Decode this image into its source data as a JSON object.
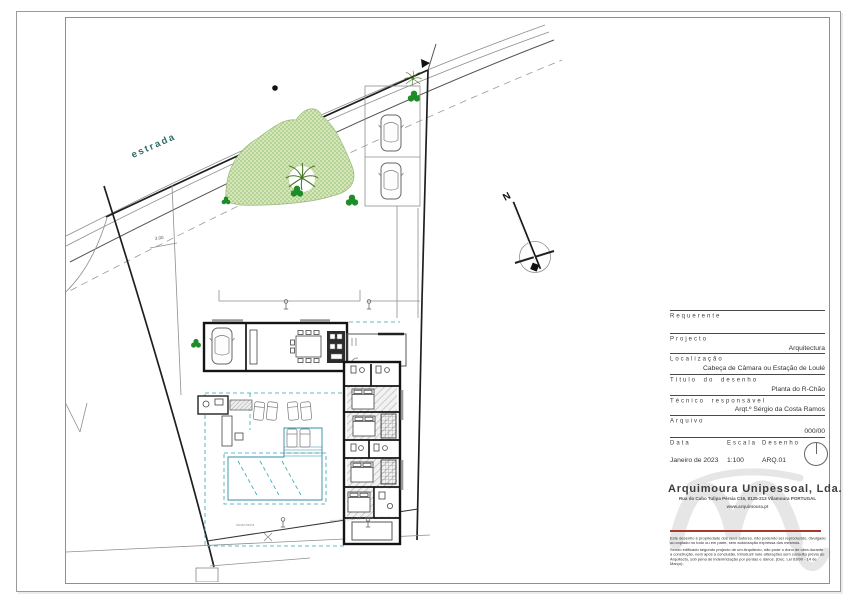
{
  "title_block": {
    "fields": [
      {
        "label": "Requerente",
        "value": ""
      },
      {
        "label": "Projecto",
        "value": "Arquitectura"
      },
      {
        "label": "Localização",
        "value": "Cabeça de Câmara ou Estação de Loulé"
      },
      {
        "label": "Título do desenho",
        "value": "Planta do R-Chão"
      },
      {
        "label": "Técnico responsável",
        "value": "Arqt.º Sérgio da Costa Ramos"
      },
      {
        "label": "Arquivo",
        "value": "000/00"
      }
    ],
    "meta": {
      "date_label": "Data",
      "date_value": "Janeiro de 2023",
      "scale_label": "Escala",
      "scale_value": "1:100",
      "drawing_label": "Desenho",
      "drawing_value": "ARQ.01"
    }
  },
  "company": {
    "name": "Arquimoura Unipessoal, Lda.",
    "address": "Rua do Cabo Tulipa Pérsia C16, 8125-213 Vilamoura PORTUGAL",
    "website": "www.arquimoura.pt",
    "disclaimer_1": "Este desenho é propriedade dos seus autores, não podendo ser reproduzido, divulgado ou copiado no todo ou em parte, sem autorização expressa dos mesmos.",
    "disclaimer_2": "Sendo edificado segundo projecto de um Arquitecto, não pode o dono de obra durante a construção, nem após a conclusão, introduzir nele alterações sem consulta prévia ao Arquitecto, sob pena de indemnização por perdas e danos. (Dec. Lei 63/90 - 14 de Março)."
  },
  "drawing": {
    "road_label": "estrada",
    "north_label": "N",
    "setback_dimension": "3.00",
    "annotation_left": "lavandaria",
    "annotation_right": "piso do r/chão 307.45m2"
  },
  "colors": {
    "pool": "#7ed1e4",
    "pool_deep": "#5fc6dc",
    "garden": "#d6e6b8",
    "garden_dot": "#8cbf6e",
    "tree": "#1e8c28",
    "palm": "#4a7729",
    "road_label": "#2a6b68",
    "teal_dash": "#35a3b0",
    "accent_red": "#a8392e",
    "wall": "#141414",
    "watermark": "#e2e2e2"
  }
}
